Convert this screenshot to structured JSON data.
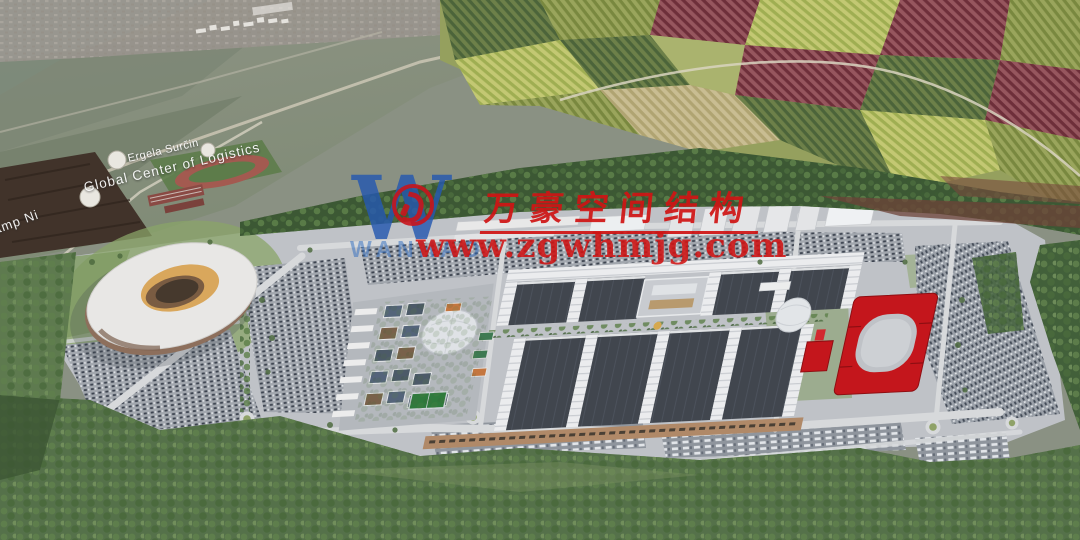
{
  "watermark": {
    "logo_letter": "W",
    "logo_subtext": "WANHAO",
    "company_name_cn": "万豪空间结构",
    "website": "www.zgwhmjg.com",
    "text_color": "#d01414",
    "logo_color": "#2558b0"
  },
  "map_labels": {
    "stud_farm": "Ergela Surčin",
    "logistics_center": "Global Center of Logistics",
    "camp": "Camp Ni"
  },
  "scene": {
    "type": "aerial-architectural-rendering",
    "landmarks": [
      "stadium",
      "exhibition-halls",
      "red-arena",
      "white-dome",
      "mixed-use-village",
      "horse-farm",
      "farmland-patchwork",
      "forest-belt",
      "parking-lots",
      "roundabouts"
    ]
  },
  "palette": {
    "site_ground": "#bfc2c7",
    "forest": "#3c5834",
    "farmland": "#95a05e",
    "hall_roof": "#41464e",
    "red_building": "#c4161c",
    "stadium_gold": "#d9a75c"
  }
}
